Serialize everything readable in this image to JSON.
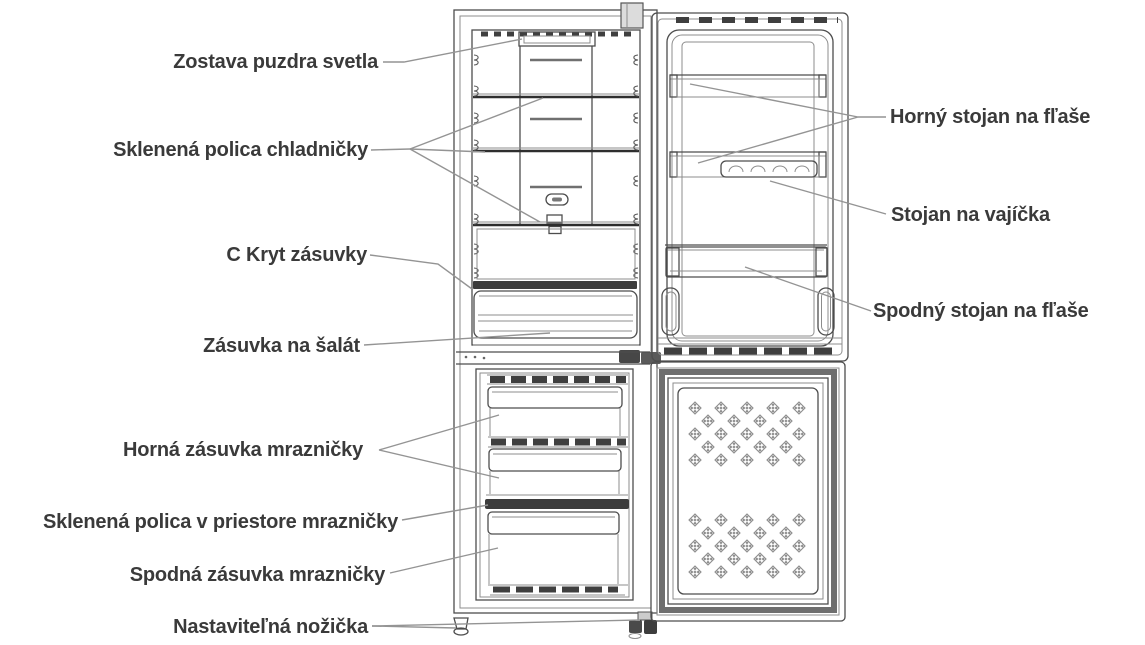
{
  "diagram": {
    "type": "refrigerator-parts-diagram",
    "language": "sk",
    "labels": {
      "left": [
        {
          "id": "light-housing-assembly",
          "text": "Zostava puzdra svetla"
        },
        {
          "id": "fridge-glass-shelf",
          "text": "Sklenená polica chladničky"
        },
        {
          "id": "drawer-cover",
          "text": "C Kryt zásuvky"
        },
        {
          "id": "salad-drawer",
          "text": "Zásuvka na šalát"
        },
        {
          "id": "upper-freezer-drawer",
          "text": "Horná zásuvka mrazničky"
        },
        {
          "id": "freezer-glass-shelf",
          "text": "Sklenená polica v priestore mrazničky"
        },
        {
          "id": "lower-freezer-drawer",
          "text": "Spodná zásuvka mrazničky"
        },
        {
          "id": "adjustable-foot",
          "text": "Nastaviteľná nožička"
        }
      ],
      "right": [
        {
          "id": "upper-bottle-rack",
          "text": "Horný stojan na fľaše"
        },
        {
          "id": "egg-rack",
          "text": "Stojan na vajíčka"
        },
        {
          "id": "lower-bottle-rack",
          "text": "Spodný stojan na fľaše"
        }
      ]
    },
    "colors": {
      "line": "#4d4d4d",
      "dark_line": "#2e2e2e",
      "leader_line": "#949494",
      "label_text": "#3a3a3a",
      "dark_band": "#3c3c3c",
      "door_pattern": "#8d8d8d",
      "background": "#ffffff"
    }
  }
}
